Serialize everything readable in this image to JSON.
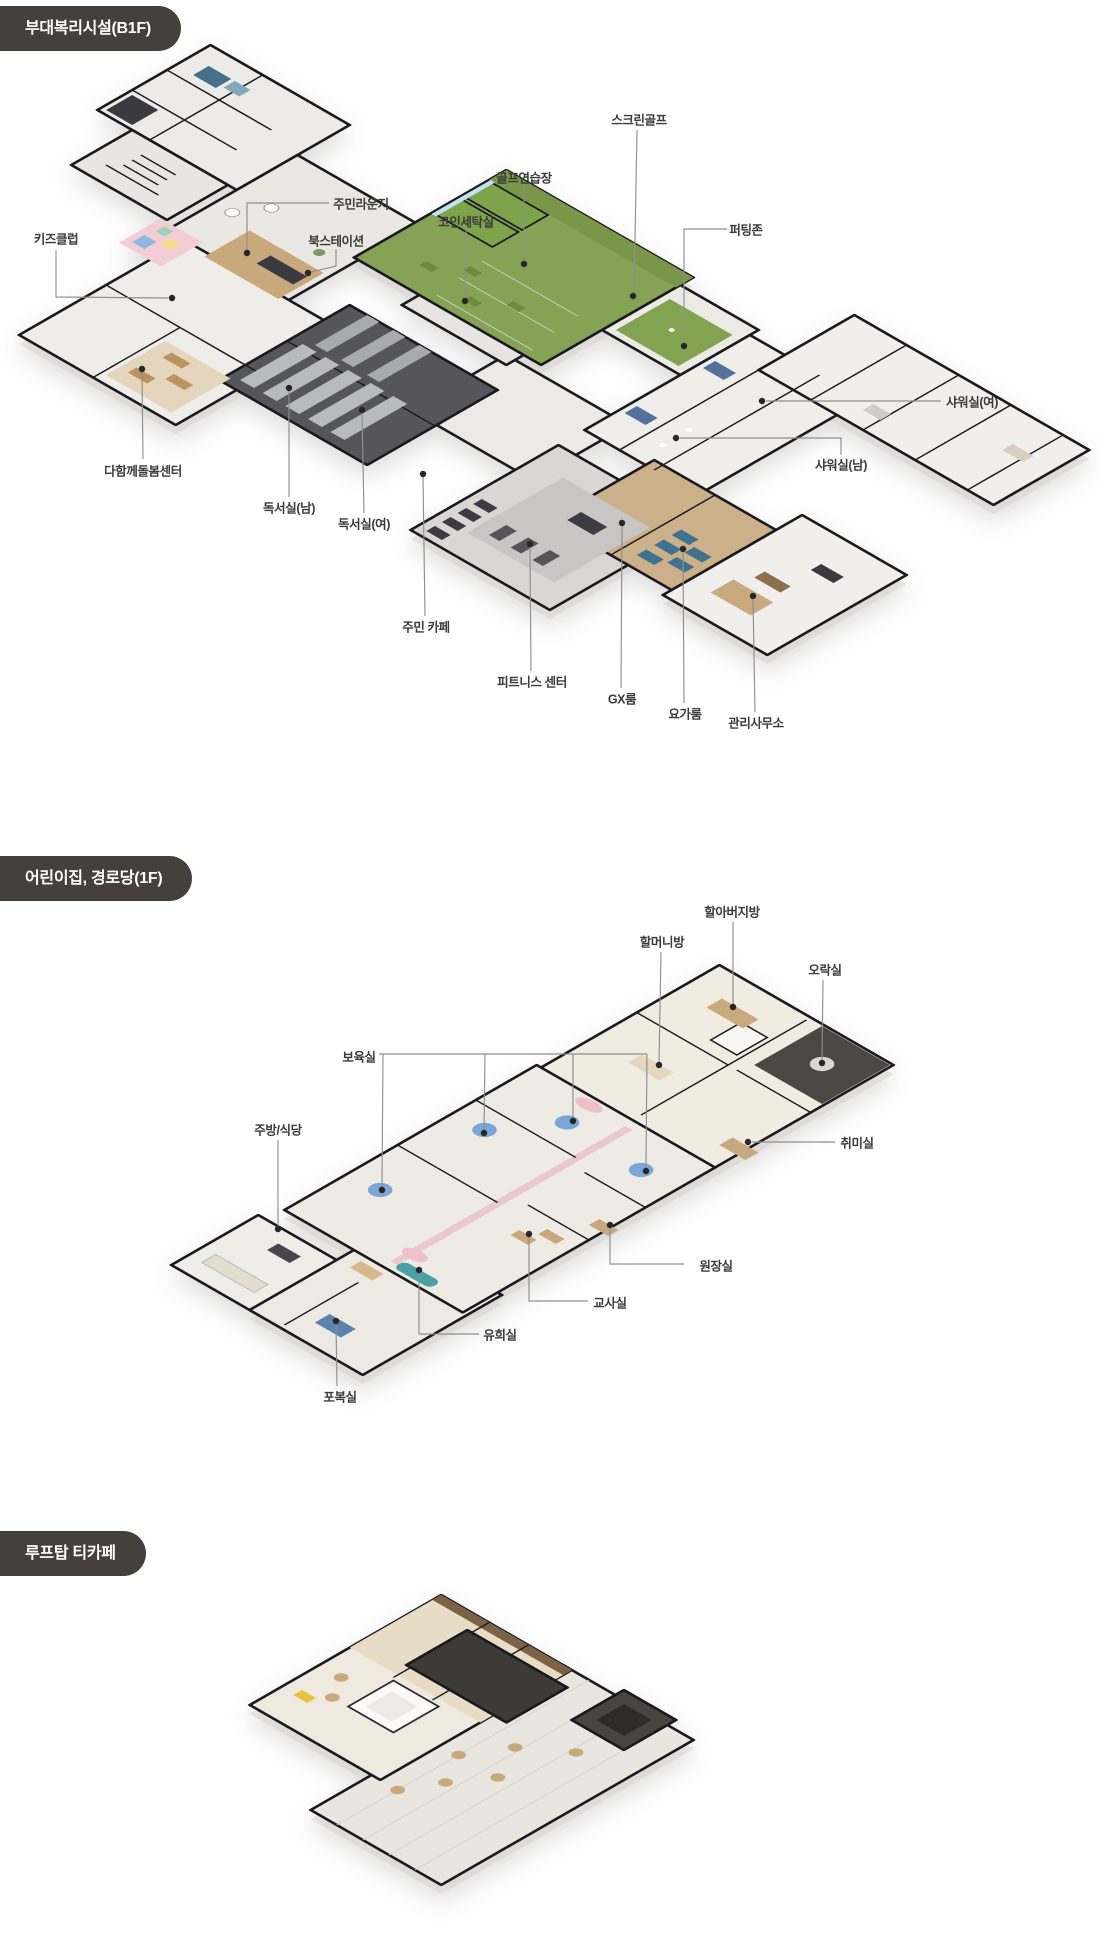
{
  "sections": [
    {
      "id": "b1f",
      "title": "부대복리시설(B1F)",
      "labels": [
        {
          "text": "키즈클럽"
        },
        {
          "text": "주민라운지"
        },
        {
          "text": "북스테이션"
        },
        {
          "text": "코인세탁실"
        },
        {
          "text": "골프연습장"
        },
        {
          "text": "스크린골프"
        },
        {
          "text": "퍼팅존"
        },
        {
          "text": "샤워실(여)"
        },
        {
          "text": "샤워실(남)"
        },
        {
          "text": "다함께돌봄센터"
        },
        {
          "text": "독서실(남)"
        },
        {
          "text": "독서실(여)"
        },
        {
          "text": "주민 카페"
        },
        {
          "text": "피트니스 센터"
        },
        {
          "text": "GX룸"
        },
        {
          "text": "요가룸"
        },
        {
          "text": "관리사무소"
        }
      ]
    },
    {
      "id": "1f",
      "title": "어린이집, 경로당(1F)",
      "labels": [
        {
          "text": "할아버지방"
        },
        {
          "text": "할머니방"
        },
        {
          "text": "오락실"
        },
        {
          "text": "보육실"
        },
        {
          "text": "주방/식당"
        },
        {
          "text": "취미실"
        },
        {
          "text": "원장실"
        },
        {
          "text": "교사실"
        },
        {
          "text": "유희실"
        },
        {
          "text": "포복실"
        }
      ]
    },
    {
      "id": "rooftop",
      "title": "루프탑 티카페",
      "labels": []
    }
  ],
  "colors": {
    "page_bg": "#ffffff",
    "header_bg": "#46403a",
    "header_text": "#ffffff",
    "label_text": "#3b3b3b",
    "leader_line": "#8f8f8f",
    "leader_dot": "#272727",
    "wall": "#1a1a1e",
    "floor_light": "#efede9",
    "golf_green": "#86a254",
    "study_dark": "#56555b",
    "wood": "#c9a87c",
    "mat_blue": "#40718f",
    "kids_pink": "#f2cdd3",
    "daycare_pink": "#ebc7ce",
    "table_blue": "#7da6d8",
    "rooftop_dark": "#3e3a36",
    "terrace_floor": "#e9e6e0"
  }
}
